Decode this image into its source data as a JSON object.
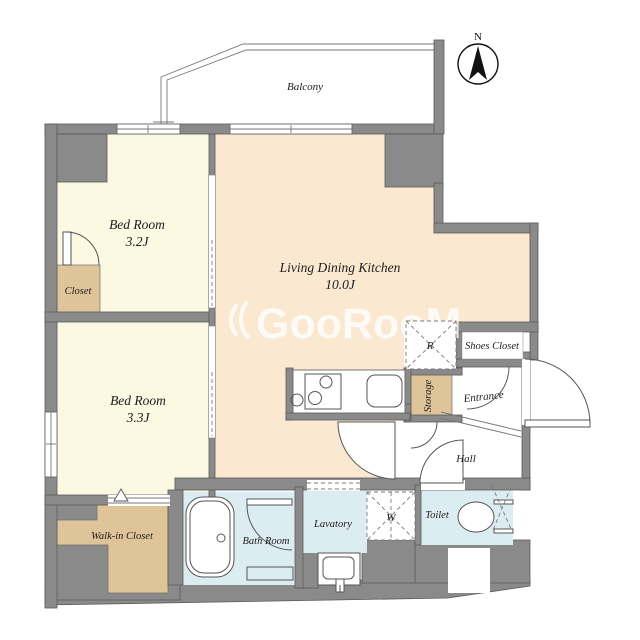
{
  "watermark": {
    "text": "GooRooM"
  },
  "compass": {
    "label": "N"
  },
  "balcony": {
    "label": "Balcony"
  },
  "rooms": {
    "bedroom1": {
      "name": "Bed Room",
      "size": "3.2J"
    },
    "bedroom2": {
      "name": "Bed Room",
      "size": "3.3J"
    },
    "ldk": {
      "name": "Living Dining Kitchen",
      "size": "10.0J"
    },
    "closet": {
      "label": "Closet"
    },
    "walkin_closet": {
      "label": "Walk-in Closet"
    },
    "shoes_closet": {
      "label": "Shoes Closet"
    },
    "storage": {
      "label": "Storage"
    },
    "entrance": {
      "label": "Entrance"
    },
    "hall": {
      "label": "Hall"
    },
    "bathroom": {
      "label": "Bath Room"
    },
    "lavatory": {
      "label": "Lavatory"
    },
    "toilet": {
      "label": "Toilet"
    }
  },
  "appliances": {
    "refrigerator": "R",
    "washer": "W"
  },
  "colors": {
    "wall": "#8a8a8a",
    "bedroom": "#fbf9e2",
    "ldk": "#fae8d0",
    "closet": "#e0c499",
    "wet_area": "#dcedf2",
    "watermark": "#ffffff"
  }
}
